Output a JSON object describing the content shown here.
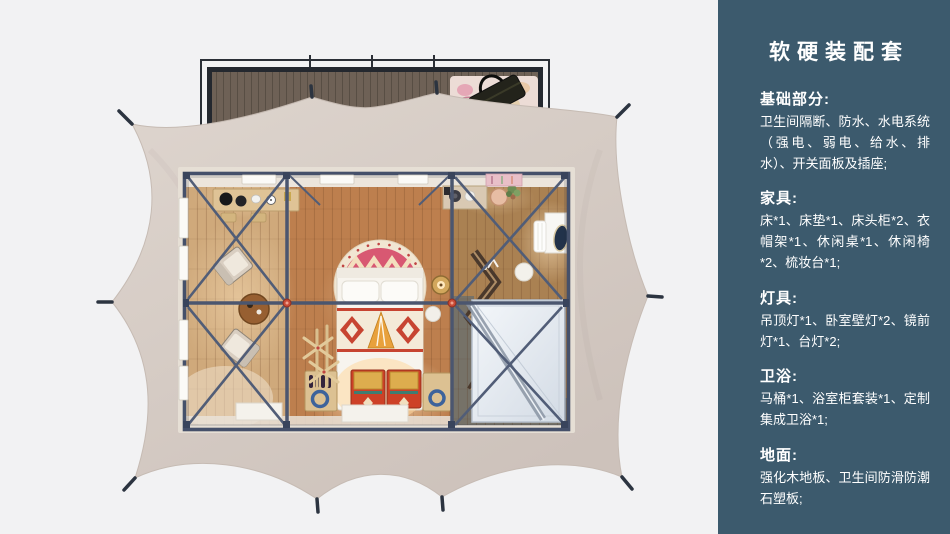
{
  "sidebar": {
    "title": "软硬装配套",
    "sections": [
      {
        "heading": "基础部分:",
        "body": "卫生间隔断、防水、水电系统（强电、弱电、给水、排水）、开关面板及插座;"
      },
      {
        "heading": "家具:",
        "body": "床*1、床垫*1、床头柜*2、衣帽架*1、休闲桌*1、休闲椅*2、梳妆台*1;"
      },
      {
        "heading": "灯具:",
        "body": "吊顶灯*1、卧室壁灯*2、镜前灯*1、台灯*2;"
      },
      {
        "heading": "卫浴:",
        "body": "马桶*1、浴室柜套装*1、定制集成卫浴*1;"
      },
      {
        "heading": "地面:",
        "body": "强化木地板、卫生间防滑防潮石塑板;"
      }
    ]
  },
  "colors": {
    "page_bg": "#f2f2f3",
    "sidebar_bg": "#3c5a6d",
    "sidebar_text": "#ffffff",
    "tent_canvas": "#d6cdc6",
    "steel_frame": "#46516b",
    "wood_floor": "#c08a5a",
    "accent_red": "#c94a36"
  },
  "floorplan": {
    "elements": [
      "porch-deck",
      "porch-rug",
      "travel-bag",
      "tent-canvas",
      "tent-stakes",
      "steel-frame",
      "console-desk",
      "lounge-chairs",
      "round-table",
      "bed",
      "round-mandala-rug",
      "dowry-chests",
      "wine-caddies",
      "clothes-rack",
      "kitchen-counter",
      "vanity-mirror",
      "vanity-stool",
      "zigzag-shelf",
      "shower-unit",
      "bedside-lamp-table",
      "windows",
      "floor-mats"
    ]
  }
}
